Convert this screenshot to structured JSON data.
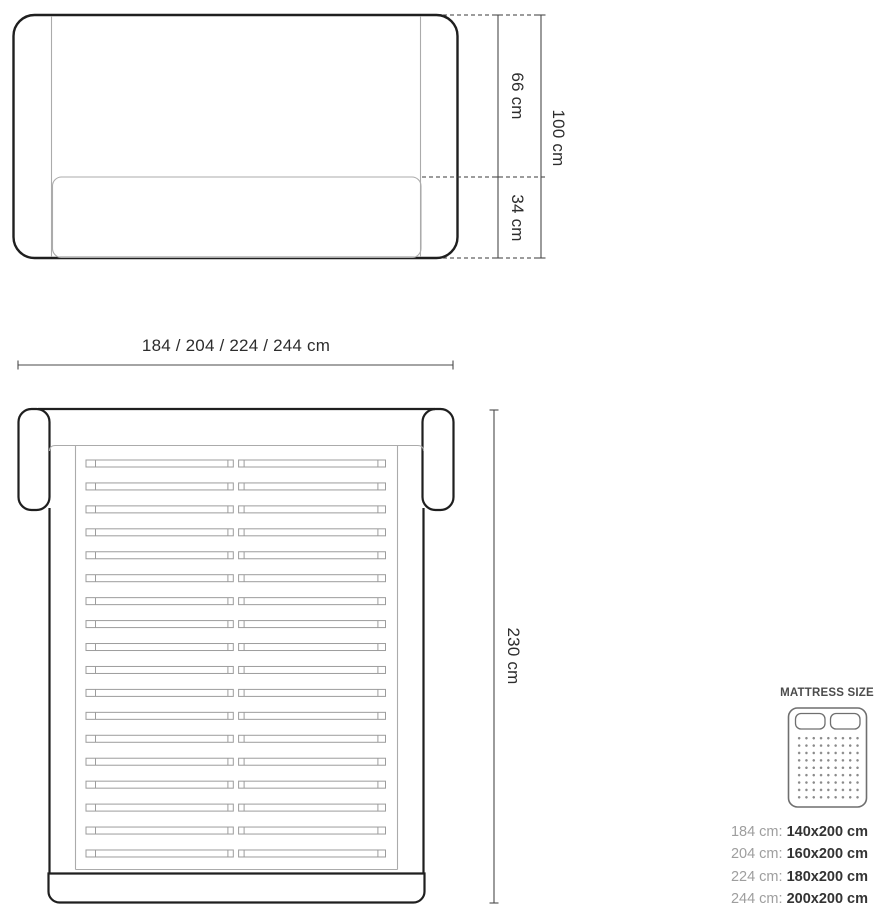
{
  "front_view": {
    "description": "bed front elevation",
    "labels": {
      "upper": "66 cm",
      "lower": "34 cm",
      "total": "100 cm"
    }
  },
  "width_dimension": {
    "label": "184 / 204 / 224 / 244 cm"
  },
  "top_view": {
    "description": "bed top view with slatted base",
    "length_label": "230 cm",
    "slat_count": 18
  },
  "legend": {
    "title": "MATTRESS SIZE",
    "rows": [
      {
        "frame": "184 cm:",
        "mattress": "140x200 cm"
      },
      {
        "frame": "204 cm:",
        "mattress": "160x200 cm"
      },
      {
        "frame": "224 cm:",
        "mattress": "180x200 cm"
      },
      {
        "frame": "244 cm:",
        "mattress": "200x200 cm"
      }
    ]
  },
  "colors": {
    "outline_dark": "#1f1f1f",
    "outline_light": "#ababab",
    "dimension": "#4a4a4a",
    "text": "#2d2d2d",
    "legend_label": "#9e9e9e",
    "legend_value": "#333333",
    "icon_stroke": "#6f6f6f",
    "dot_color": "#8a8a8a",
    "bg": "#ffffff"
  }
}
